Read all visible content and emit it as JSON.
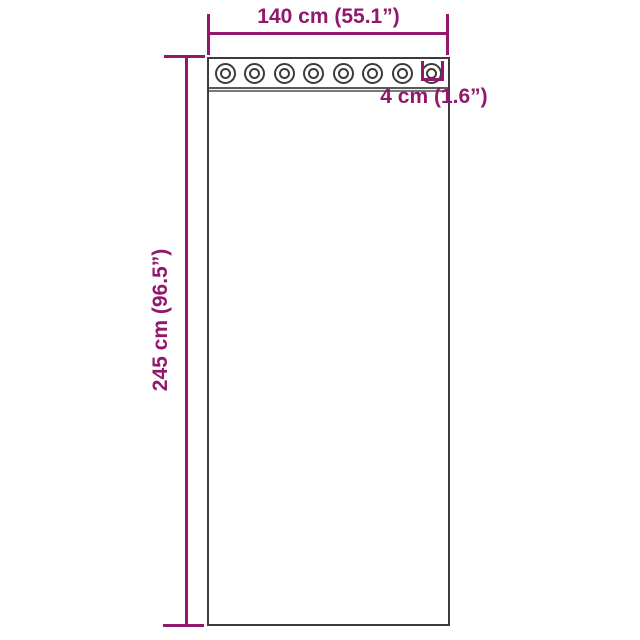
{
  "diagram": {
    "kind": "curtain-dimension-diagram",
    "curtain": {
      "grommet_count": 8
    },
    "dimensions": {
      "width_label": "140 cm (55.1”)",
      "height_label": "245 cm (96.5”)",
      "grommet_diameter_label": "4 cm (1.6”)"
    },
    "colors": {
      "dimension_accent": "#92186d",
      "outline": "#3b3b3b",
      "background": "#ffffff"
    }
  }
}
